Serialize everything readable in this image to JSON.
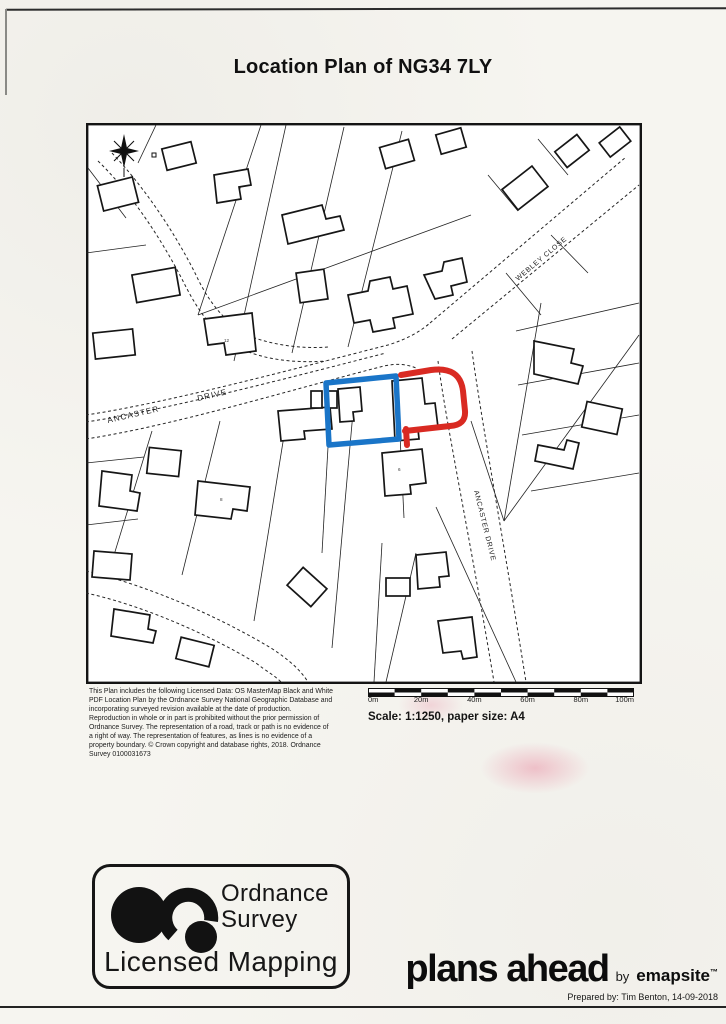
{
  "page": {
    "title": "Location Plan of NG34 7LY"
  },
  "map": {
    "street_labels": {
      "ancaster_word1": "ANCASTER",
      "ancaster_word2": "DRIVE",
      "webley_close": "WEBLEY CLOSE",
      "ancaster_drive_south": "ANCASTER DRIVE"
    },
    "house_numbers": [
      "12",
      "8",
      "6"
    ],
    "highlight_colors": {
      "subject_plot_red": "#d92a22",
      "adjacent_plot_blue": "#1a75c8"
    }
  },
  "legal": {
    "text": "This Plan includes the following Licensed Data: OS MasterMap Black and White\nPDF Location Plan by the Ordnance Survey National Geographic Database and\nincorporating surveyed revision available at the date of production.\nReproduction in whole or in part is prohibited without the prior permission of\nOrdnance Survey. The representation of a road, track or path is no evidence of\na right of way. The representation of features, as lines is no evidence of a\nproperty boundary. © Crown copyright and database rights, 2018. Ordnance\nSurvey 0100031673"
  },
  "scale": {
    "bar_labels": [
      "0m",
      "20m",
      "40m",
      "60m",
      "80m",
      "100m"
    ],
    "caption": "Scale: 1:1250, paper size: A4"
  },
  "os_logo": {
    "name_line1": "Ordnance",
    "name_line2": "Survey",
    "licensed": "Licensed Mapping"
  },
  "footer": {
    "brand": "plans ahead",
    "by": "by",
    "brand2": "emapsite",
    "tm": "™",
    "prepared": "Prepared by: Tim Benton, 14-09-2018"
  }
}
